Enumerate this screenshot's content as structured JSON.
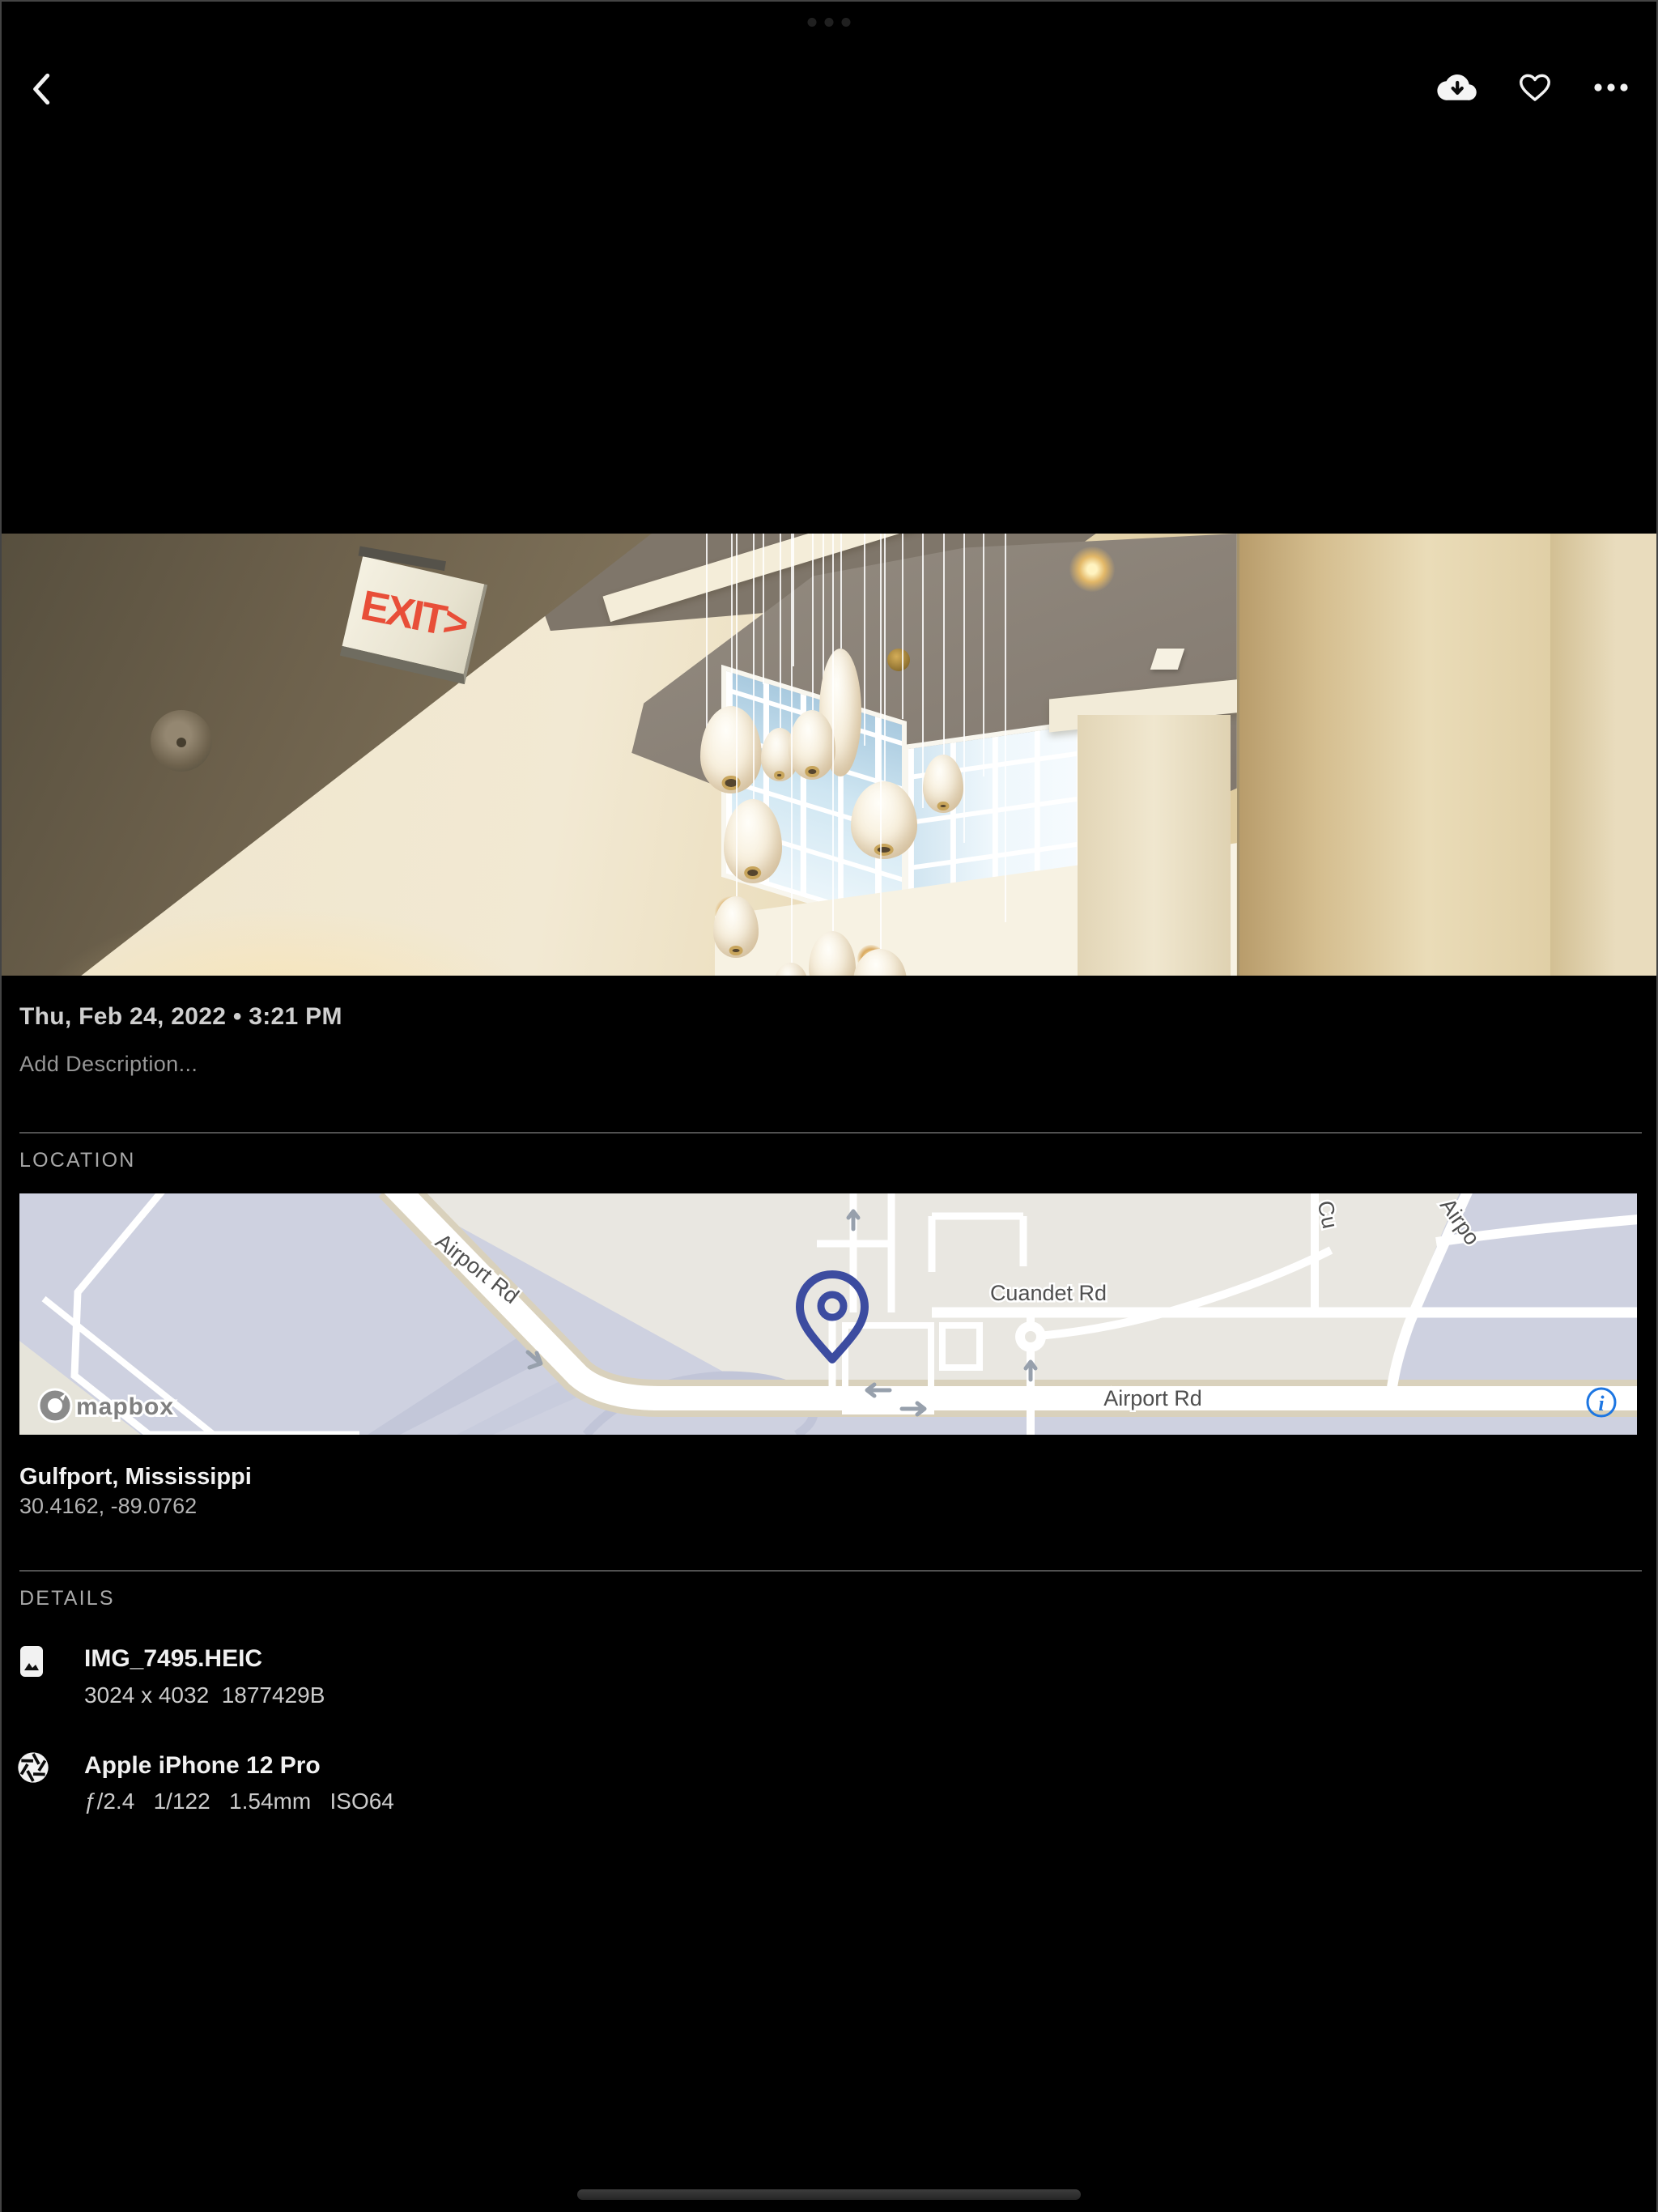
{
  "accent": {
    "pin_blue": "#3c4ca0",
    "info_blue": "#1d76e2",
    "exit_red": "#e84e38",
    "map_land": "#e9e7e1",
    "map_field": "#ced1e0"
  },
  "toolbar": {},
  "photo": {
    "exit_sign_text": "EXIT>"
  },
  "info": {
    "datetime": "Thu, Feb 24, 2022 • 3:21 PM",
    "description_placeholder": "Add Description...",
    "location": {
      "section_label": "LOCATION",
      "place": "Gulfport, Mississippi",
      "coordinates": "30.4162, -89.0762",
      "map": {
        "labels": {
          "airport_rd_diagonal": "Airport Rd",
          "cuandet_rd": "Cuandet Rd",
          "airport_rd_horizontal": "Airport Rd",
          "partial_top_right_road": "Cu",
          "partial_top_right_airport": "Airpo"
        },
        "attribution": "mapbox"
      }
    },
    "details": {
      "section_label": "DETAILS",
      "file": {
        "name": "IMG_7495.HEIC",
        "meta": "3024 x 4032  1877429B"
      },
      "camera": {
        "name": "Apple iPhone 12 Pro",
        "exif": "ƒ/2.4   1/122   1.54mm   ISO64"
      }
    }
  }
}
